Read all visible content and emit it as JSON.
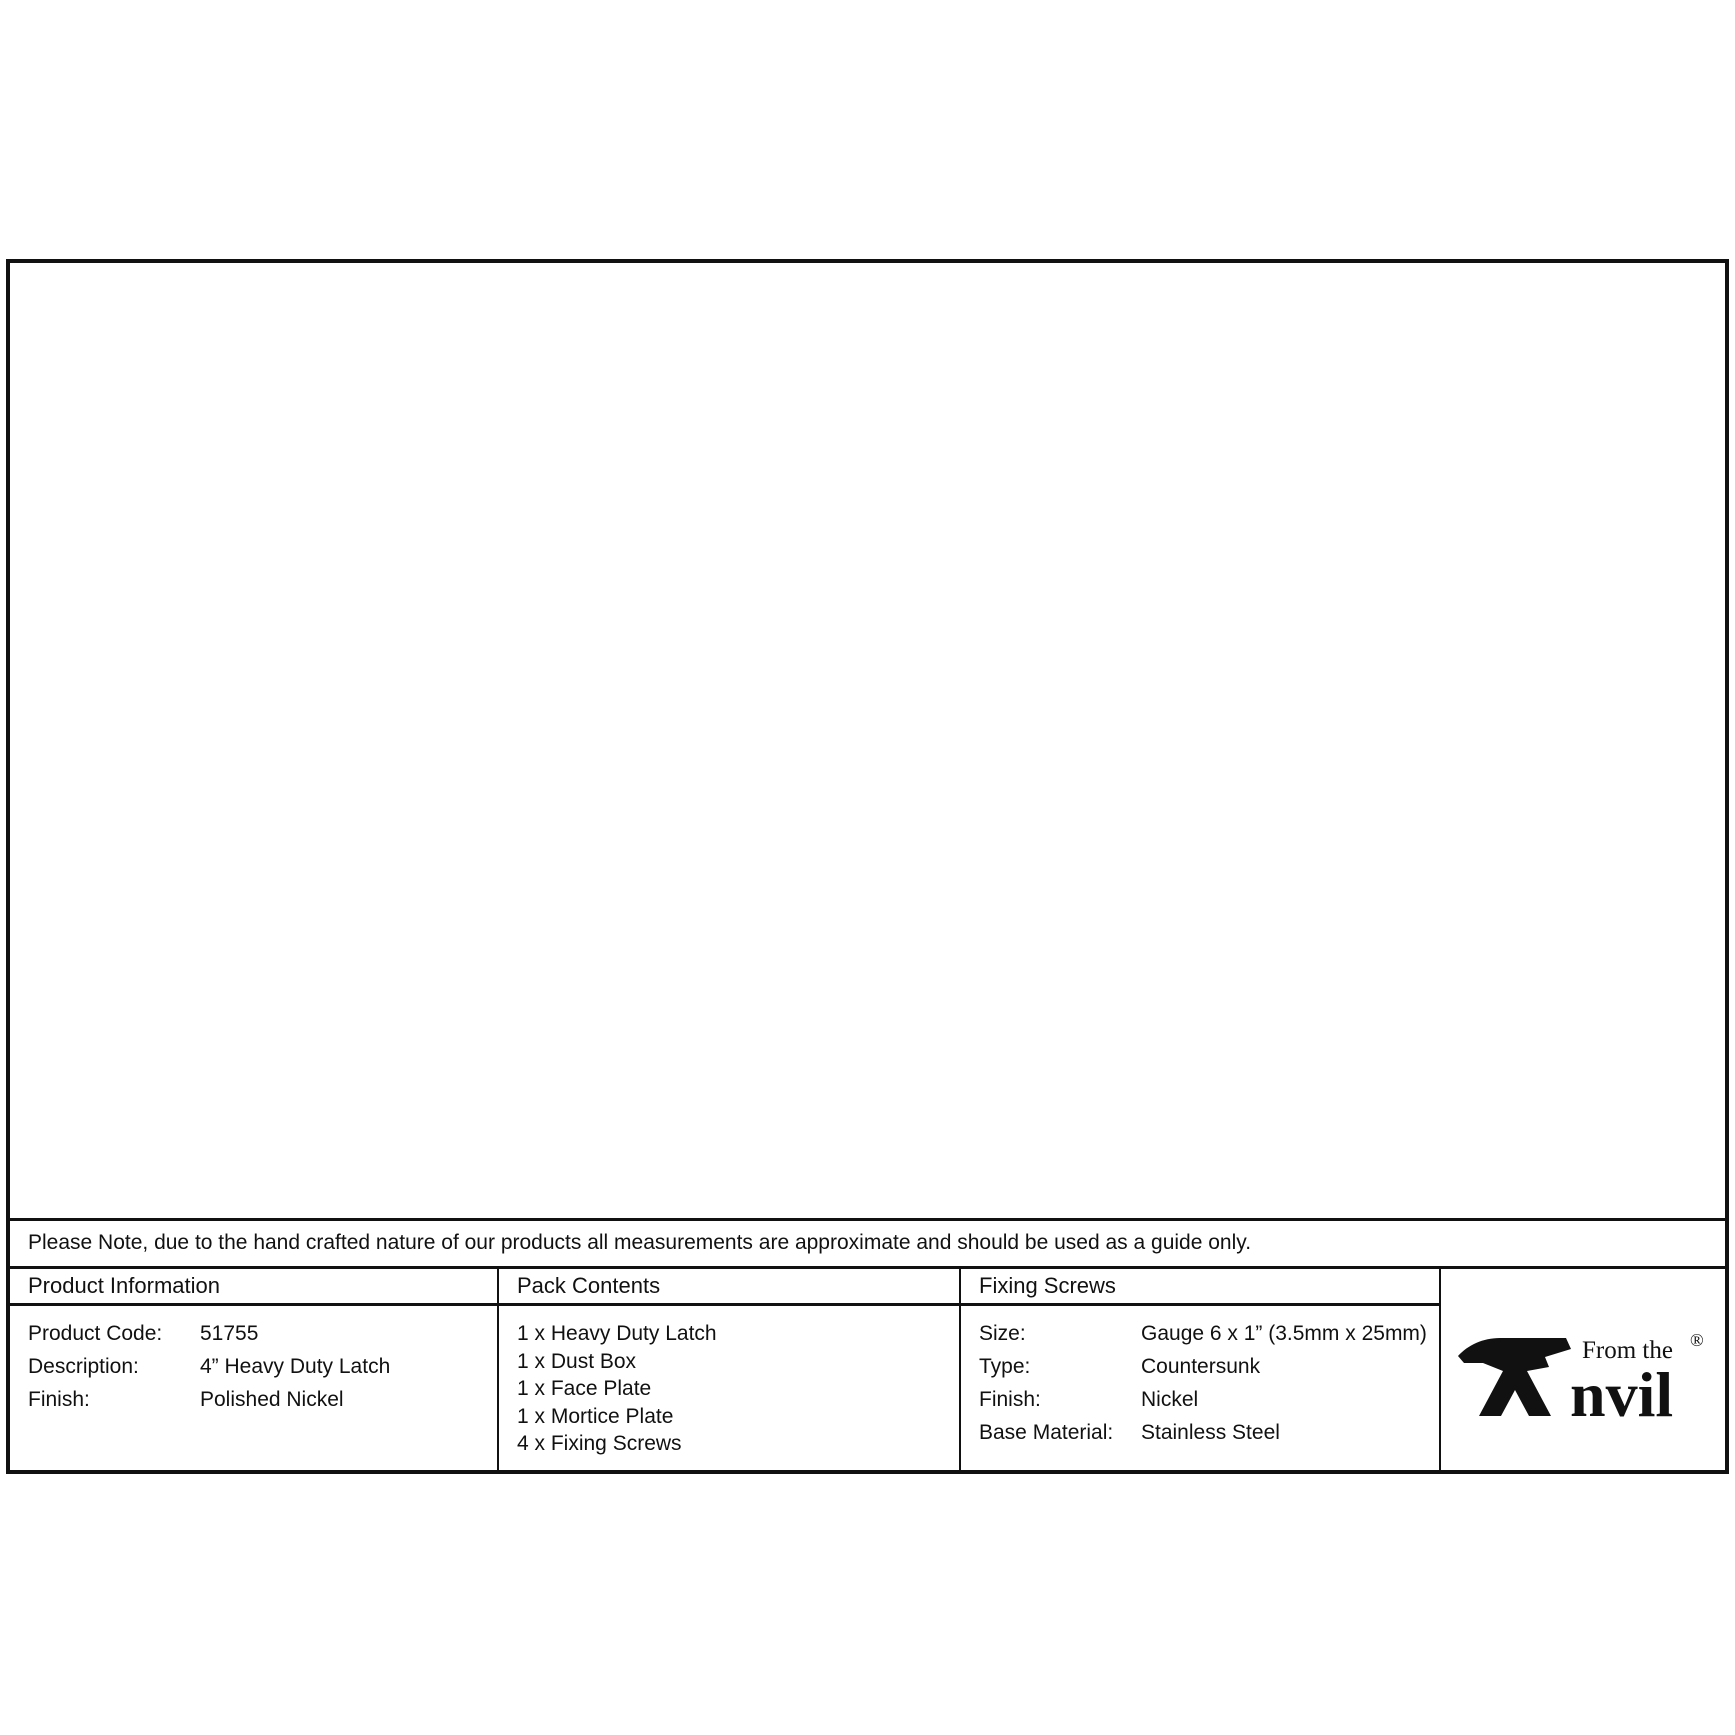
{
  "note": "Please Note, due to the hand crafted nature of our products all measurements are approximate and should be used as a guide only.",
  "dims": {
    "latch": {
      "overall": "103",
      "backset": "82",
      "bolt_height": "19",
      "body_height": "23",
      "plate_thickness": "3"
    },
    "faceplate": {
      "overall_height": "40",
      "plate_height": "25",
      "hole_spacing": "45",
      "width": "65"
    },
    "mortice": {
      "width": "60",
      "hole_spacing": "45",
      "height": "25"
    }
  },
  "table": {
    "columns": {
      "product": "Product Information",
      "pack": "Pack Contents",
      "screws": "Fixing Screws"
    },
    "product_rows": [
      {
        "label": "Product Code:",
        "value": "51755"
      },
      {
        "label": "Description:",
        "value": "4” Heavy Duty Latch"
      },
      {
        "label": "Finish:",
        "value": "Polished Nickel"
      }
    ],
    "pack_items": [
      "1 x Heavy Duty Latch",
      "1 x Dust Box",
      "1 x Face Plate",
      "1 x Mortice Plate",
      "4 x Fixing Screws"
    ],
    "screws_rows": [
      {
        "label": "Size:",
        "value": "Gauge 6 x 1” (3.5mm x 25mm)"
      },
      {
        "label": "Type:",
        "value": "Countersunk"
      },
      {
        "label": "Finish:",
        "value": "Nickel"
      },
      {
        "label": "Base Material:",
        "value": "Stainless Steel"
      }
    ]
  },
  "logo": {
    "from_the": "From the",
    "name": "nvil",
    "registered": "®"
  }
}
